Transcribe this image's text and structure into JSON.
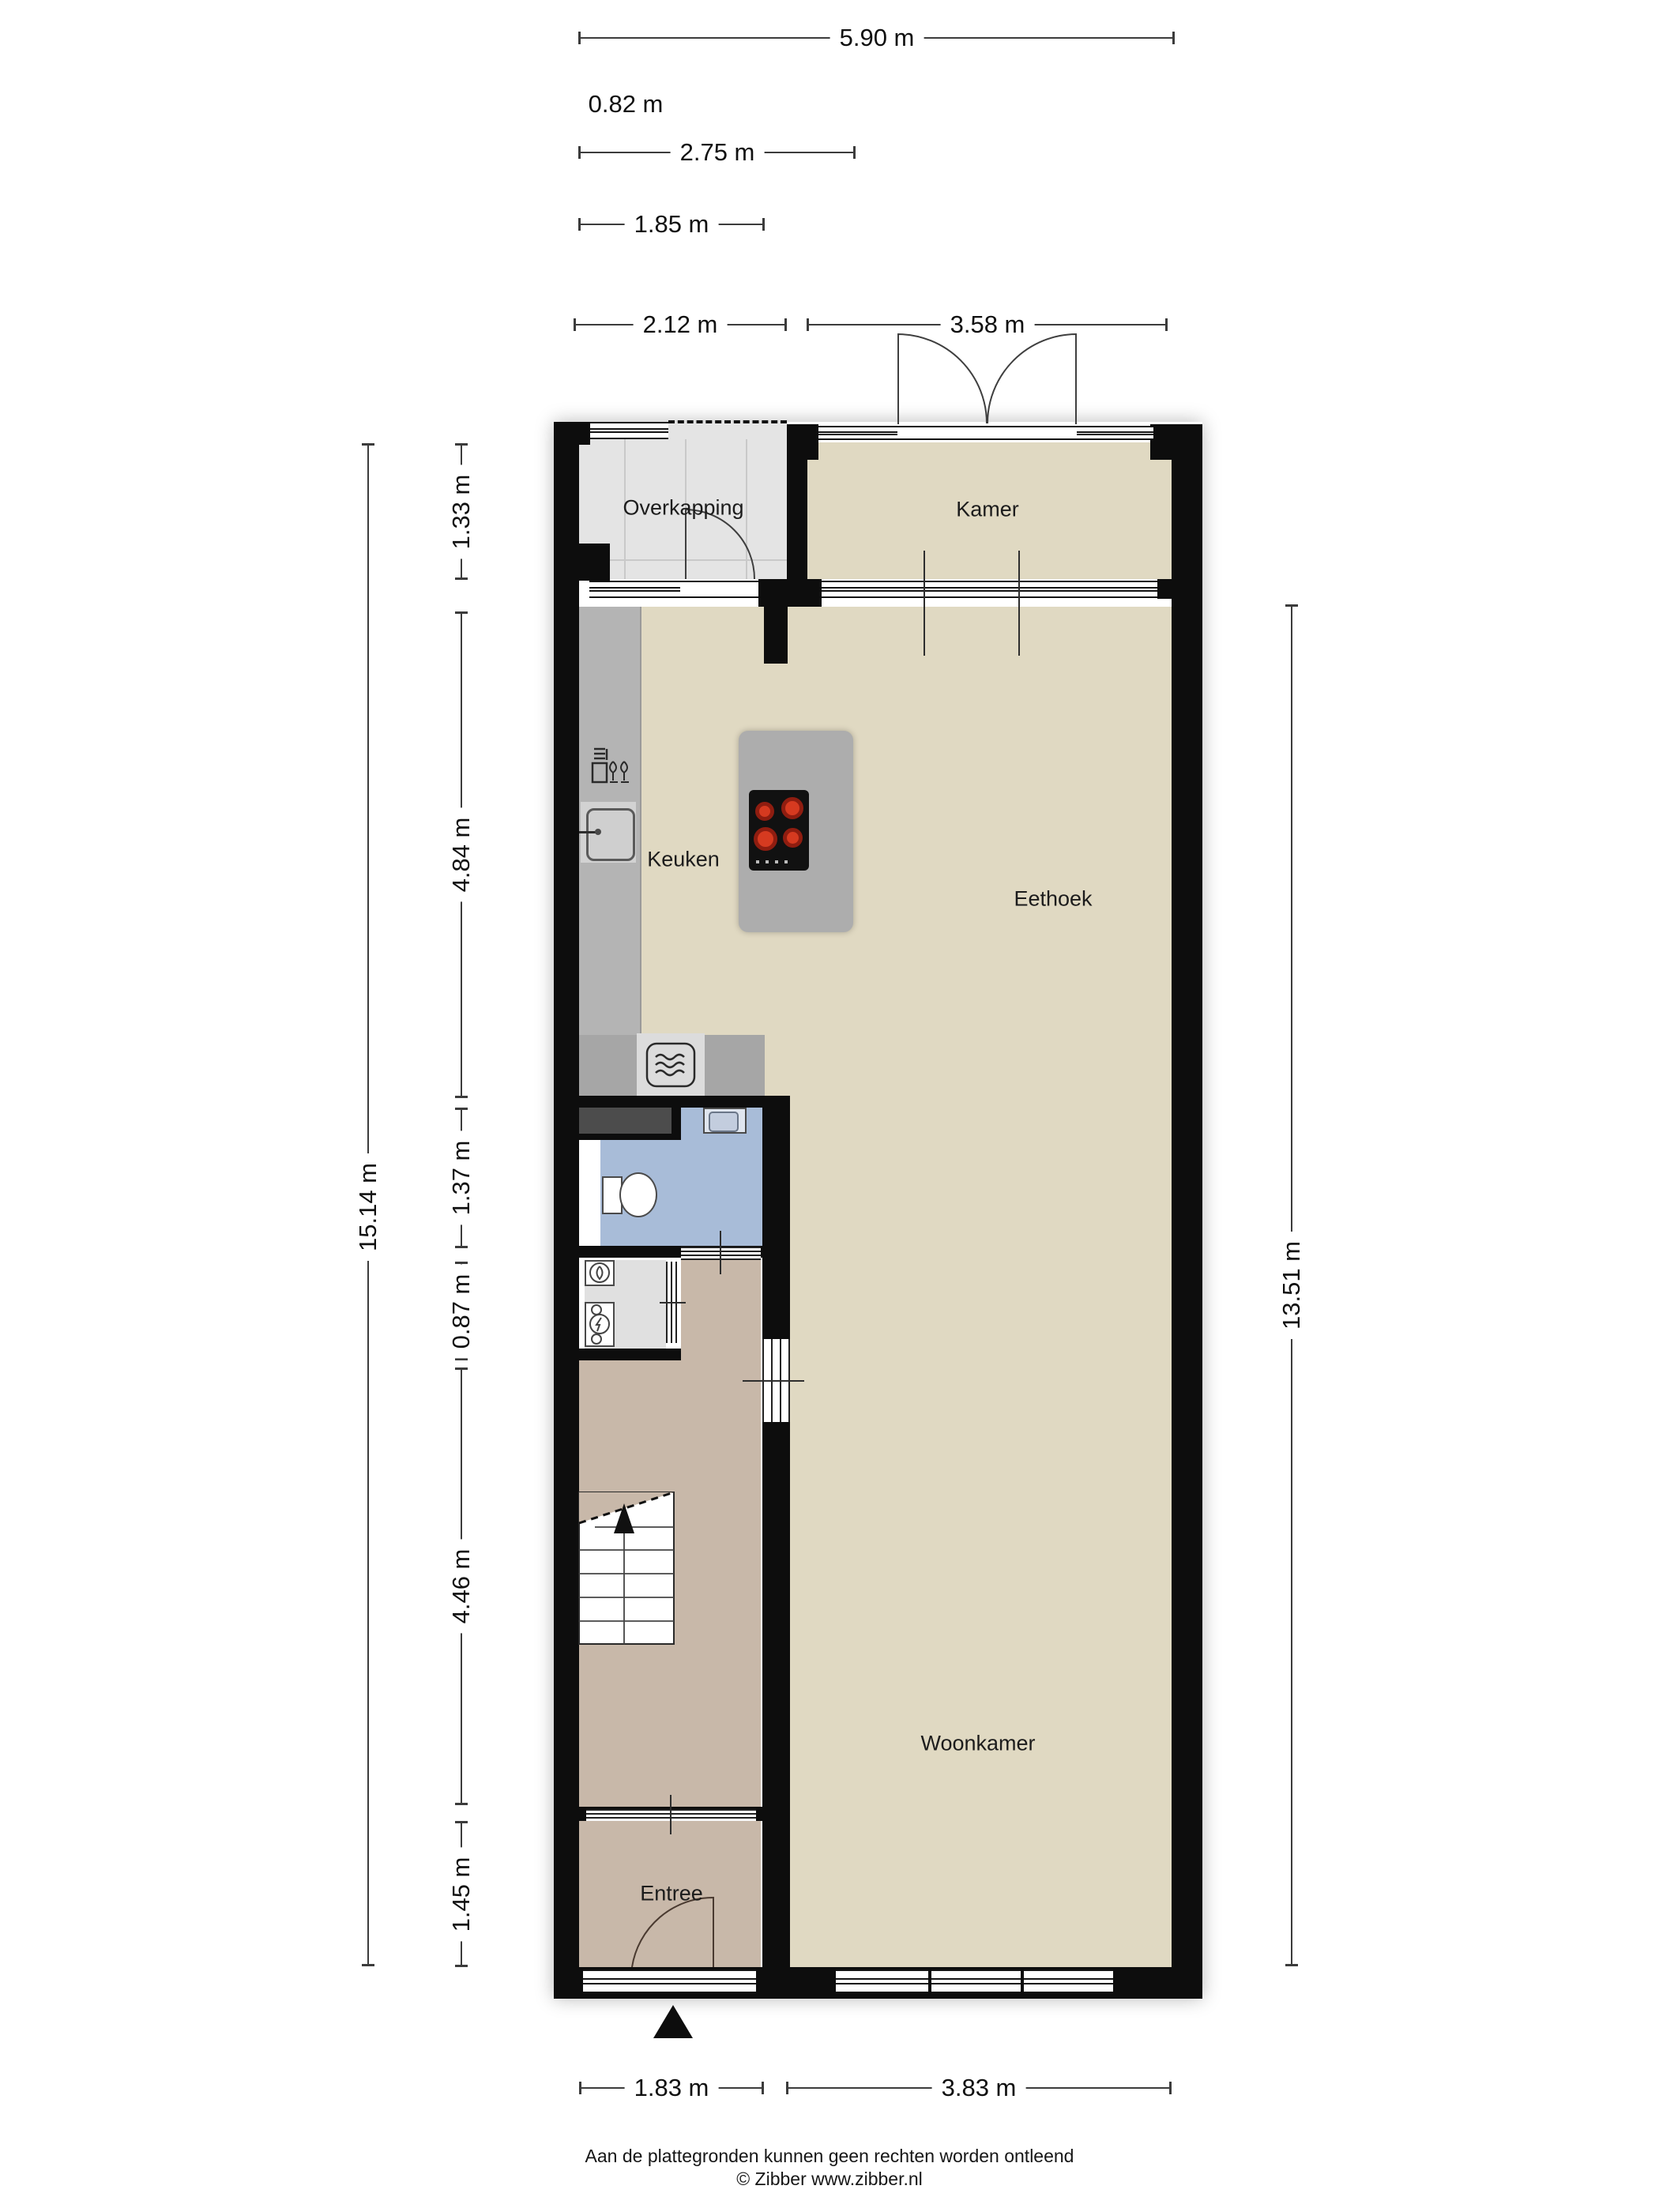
{
  "rooms": {
    "overkapping": "Overkapping",
    "kamer": "Kamer",
    "keuken": "Keuken",
    "eethoek": "Eethoek",
    "woonkamer": "Woonkamer",
    "entree": "Entree"
  },
  "dimensions": {
    "top": [
      "5.90 m",
      "0.82 m",
      "2.75 m",
      "1.85 m",
      "2.12 m",
      "3.58 m"
    ],
    "left_total": "15.14 m",
    "left": [
      "1.33 m",
      "4.84 m",
      "1.37 m",
      "0.87 m",
      "4.46 m",
      "1.45 m"
    ],
    "right": "13.51 m",
    "bottom": [
      "1.83 m",
      "3.83 m"
    ]
  },
  "footer": {
    "disclaimer": "Aan de plattegronden kunnen geen rechten worden ontleend",
    "copyright": "© Zibber www.zibber.nl"
  },
  "icons": {
    "stove": "cooktop-4-burners",
    "sink": "kitchen-sink",
    "dishwasher": "dishwasher-glass-fork",
    "microwave": "microwave-oven",
    "toilet": "toilet",
    "hand-basin": "small-sink",
    "washer": "washing-machine",
    "dryer": "dryer-lightning",
    "stairs": "staircase-up",
    "entrance-arrow": "entrance-marker"
  },
  "colors": {
    "wall": "#0d0d0d",
    "floor_beige": "#e0d9c2",
    "floor_taupe": "#c8b8a9",
    "toilet_blue": "#a8bcd8",
    "overkapping_gray": "#e4e4e4",
    "counter_gray": "#b4b4b4",
    "island_gray": "#adadad",
    "burner_red": "#d63a20"
  }
}
